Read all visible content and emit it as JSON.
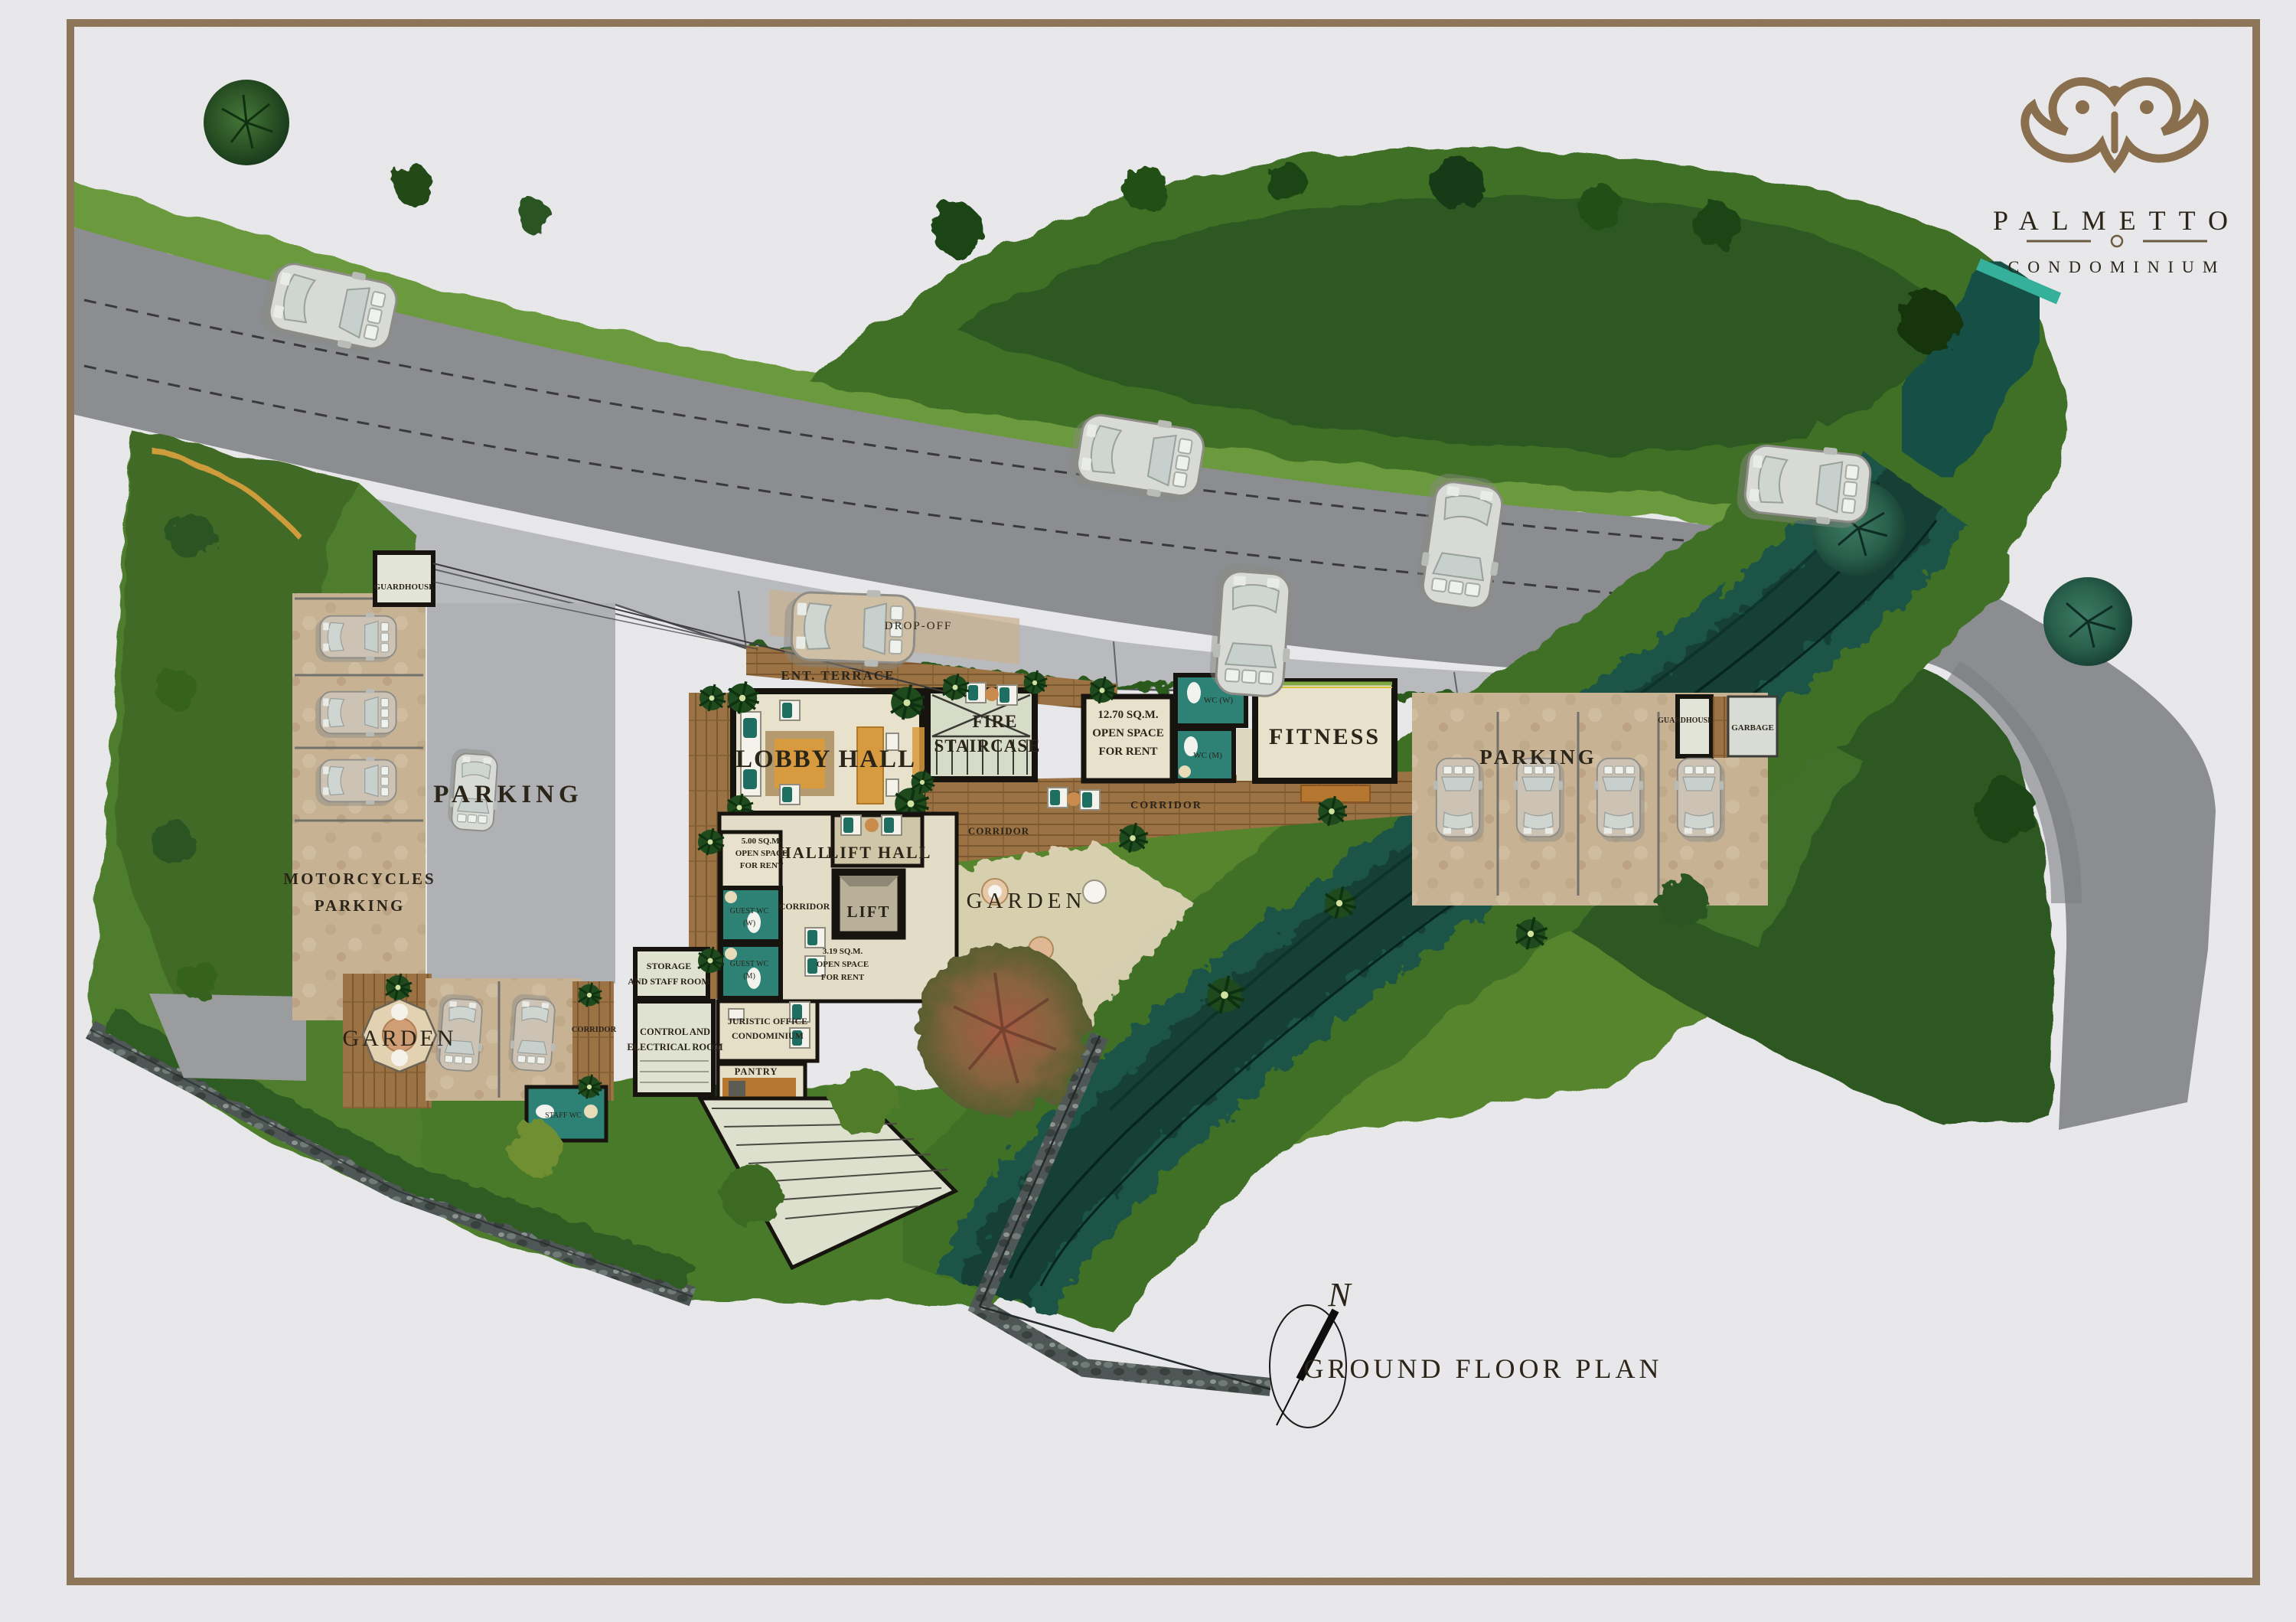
{
  "brand": {
    "name": "PALMETTO",
    "subtitle": "CONDOMINIUM"
  },
  "titleblock": {
    "plan_title": "GROUND FLOOR PLAN",
    "north_letter": "N"
  },
  "site": {
    "parking_left": "PARKING",
    "parking_right": "PARKING",
    "motorcycles_line1": "MOTORCYCLES",
    "motorcycles_line2": "PARKING",
    "guardhouse_left": "GUARDHOUSE",
    "guardhouse_right": "GUARDHOUSE",
    "garbage": "GARBAGE",
    "garden_west": "GARDEN",
    "garden_central": "GARDEN",
    "drop_off": "DROP-OFF",
    "ent_terrace": "ENT. TERRACE",
    "corridor_main": "CORRIDOR",
    "corridor_inner": "CORRIDOR",
    "corridor_hall": "CORRIDOR",
    "corridor_west": "CORRIDOR"
  },
  "rooms": {
    "lobby_hall": "LOBBY HALL",
    "fire_line1": "FIRE",
    "fire_line2": "STAIRCASE",
    "fitness": "FITNESS",
    "hall": "HALL",
    "lift_hall": "LIFT HALL",
    "lift": "LIFT",
    "wc_w": "WC (W)",
    "wc_m": "WC (M)",
    "guest_wc_w_line1": "GUEST WC",
    "guest_wc_w_line2": "(W)",
    "guest_wc_m_line1": "GUEST WC",
    "guest_wc_m_line2": "(M)",
    "staff_wc": "STAFF WC",
    "storage_line1": "STORAGE",
    "storage_line2": "AND STAFF ROOM",
    "control_line1": "CONTROL AND",
    "control_line2": "ELECTRICAL ROOM",
    "juristic_line1": "JURISTIC OFFICE",
    "juristic_line2": "CONDOMINIUM",
    "pantry": "PANTRY",
    "rent1270_line1": "12.70 SQ.M.",
    "rent1270_line2": "OPEN SPACE",
    "rent1270_line3": "FOR RENT",
    "rent500_line1": "5.00 SQ.M.",
    "rent500_line2": "OPEN SPACE",
    "rent500_line3": "FOR RENT",
    "rent319_line1": "3.19 SQ.M.",
    "rent319_line2": "OPEN SPACE",
    "rent319_line3": "FOR RENT"
  },
  "colors": {
    "paper": "#ebebed",
    "frame": "#8d7557",
    "road": "#8b8d90",
    "apron": "#b9babd",
    "grass": "#6a9a3e",
    "forest": "#2d5822",
    "stream": "#1b5547",
    "deck_wood": "#9a7243",
    "floor_cream": "#e8e1cb",
    "wall_black": "#17130e",
    "wc_teal": "#2d8175",
    "parking_tan": "#c7b294",
    "title_green": "#33584a",
    "logo_brown": "#8a6f4e"
  }
}
